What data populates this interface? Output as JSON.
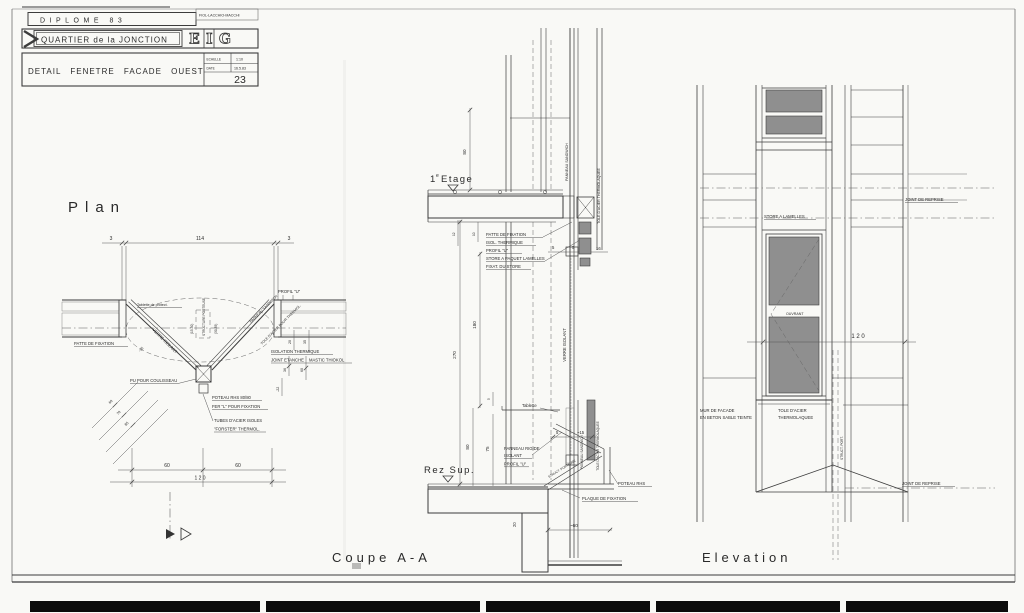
{
  "title_block": {
    "diplome": "DIPLOME 83",
    "authors": "FIOL-LACCHIO-MACCHI",
    "project": "QUARTIER de la JONCTION",
    "logo_letters": {
      "e": "E",
      "i": "I",
      "g": "G"
    },
    "drawing_title": "DETAIL FENETRE FACADE OUEST",
    "scale_label": "ECHELLE",
    "scale_value": "1:10",
    "date_label": "DATE",
    "date_value": "16.5.83",
    "sheet_number": "23"
  },
  "plan": {
    "title": "Plan",
    "dims": {
      "left_gap": "3",
      "opening": "114",
      "right_gap": "3",
      "offset_35": "-35",
      "d20": "20",
      "d35": "35",
      "d36": "36",
      "d60": "60",
      "d22": "-22",
      "diag_60": "60",
      "diag_70": "70",
      "diag_85": "85",
      "bottom_60a": "60",
      "bottom_60b": "60",
      "bottom_120": "1 2 0",
      "struct_a": "(15-30)",
      "struct_b": "(30-35)"
    },
    "labels": {
      "profil_u": "PROFIL \"U\"",
      "tablette": "Tablette de protect.",
      "patte": "PATTE DE FIXATION",
      "verre_isolant": "VERRE ISOLANT",
      "structure_porteuse": "STRUCTURE PORTEUSE",
      "panneau_sandwich": "PANNEAU SANDWICH",
      "tole_acier": "TOLE D'ACIER POUR THERMOL.",
      "isolation": "ISOLATION THERMIQUE",
      "joint_etanche": "JOINT ETANCHE",
      "mastic": "MASTIC THIOKOL",
      "pu_coulisseau": "PU POUR COULISSEAU",
      "poteau": "POTEAU RHS 80/80",
      "fer_l": "FER \"L\" POUR FIXATION",
      "tubes": "TUBES D'ACIER ISOLES",
      "forster": "\"FORSTER\" THERMOL."
    },
    "section_letter": "A"
  },
  "coupe": {
    "level1_num": "1",
    "level1_sup": "e",
    "level1_name": "Etage",
    "level0": "Rez Sup.",
    "dims": {
      "d80_top": "80",
      "d12": "12",
      "d10": "10",
      "d5a": "5",
      "d5b": "5",
      "d16": "16",
      "d180": "180",
      "d270": "270",
      "d5c": "5",
      "d80_bot": "80",
      "d75": "75",
      "d5d": "5",
      "d15": "~15",
      "d20": "20",
      "d60": "~60"
    },
    "labels": {
      "patte": "PATTE DE FIXATION",
      "isol": "ISOL. THERMIQUE",
      "profil_u": "PROFIL \"U\"",
      "store_paquet": "STORE A PAQUET LAMELLES",
      "fixat_store": "FIXAT. DU STORE",
      "panneau_sandwich_top": "PANNEAU SANDWICH",
      "tole_top": "TOLE D'ACIER THERMOLAQUEE",
      "verre_isolant": "VERRE ISOLANT",
      "tablette": "Tablette",
      "panneau_rigide": "PANNEAU RIGIDE",
      "isolant": "ISOLANT",
      "profil_u2": "PROFIL \"U\"",
      "struct_porteuse": "STRUCT. PORTEUSE",
      "panneau_sandwich_bot": "PANNEAU SANDWICH",
      "tole_bot": "TOLE D'ACIER THERMOLAQUEE",
      "plaque": "PLAQUE DE FIXATION",
      "poteau": "POTEAU RHS"
    }
  },
  "elevation": {
    "joint_reprise_top": "JOINT DE REPRISE",
    "joint_reprise_bottom": "JOINT DE REPRISE",
    "store_lamelles": "STORE A LAMELLES",
    "ouvrant": "OUVRANT",
    "dim_120": "1 2 0",
    "mur_line1": "MUR DE FACADE",
    "mur_line2": "EN BETON SABLE TEINTE",
    "tole_line1": "TOLE D'ACIER",
    "tole_line2": "THERMOLAQUEE",
    "struct_port": "STRUCT. PORT."
  },
  "footer": {
    "coupe_title": "Coupe A-A",
    "elevation_title": "Elevation"
  }
}
